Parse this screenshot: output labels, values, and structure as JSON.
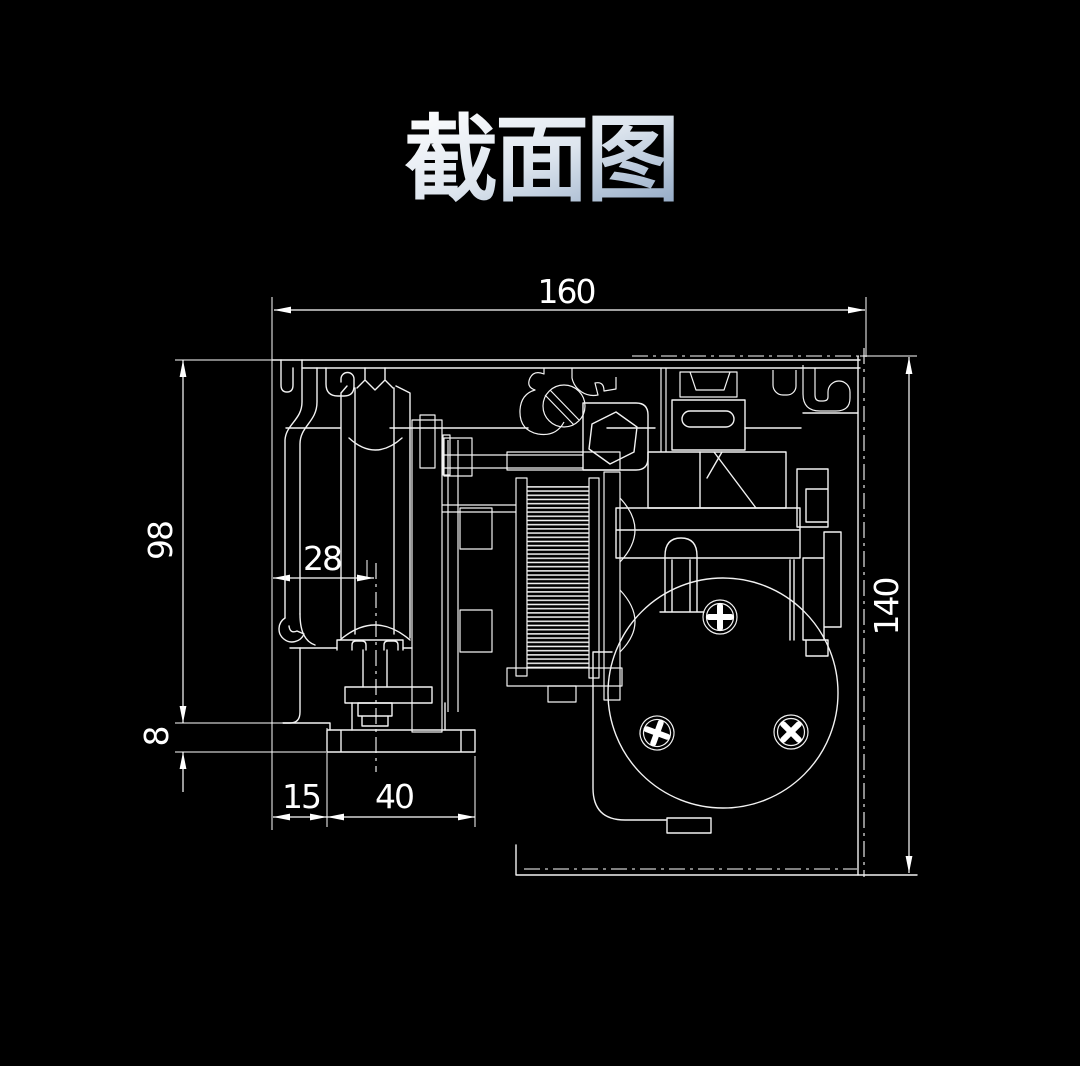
{
  "title": {
    "text": "截面图"
  },
  "dimensions": {
    "top_width": "160",
    "left_height": "98",
    "roller_offset": "28",
    "lip_height": "8",
    "foot_offset": "15",
    "foot_width": "40",
    "right_height": "140"
  },
  "colors": {
    "background": "#000000",
    "line": "#ffffff",
    "title_gradient_start": "#ffffff",
    "title_gradient_mid": "#dde5ee",
    "title_gradient_end": "#8ea6c3"
  }
}
